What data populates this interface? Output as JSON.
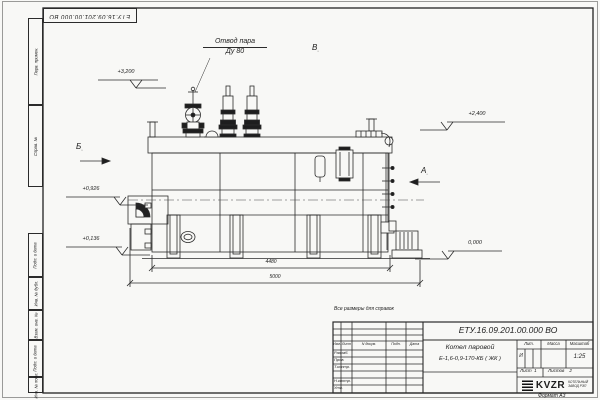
{
  "sheet": {
    "stamp_top": "ЕТУ.16.09.201.00.000  ВО",
    "format_note": "Формат  А3",
    "reference_note": "Все размеры для справок"
  },
  "margin": {
    "labels": [
      "Перв. примен.",
      "Справ. №",
      "Подп. и дата",
      "Инв. № дубл.",
      "Взам. инв. №",
      "Подп. и дата",
      "Инв. № подл."
    ]
  },
  "callouts": {
    "steam_outlet_line1": "Отвод пара",
    "steam_outlet_line2": "Ду 80",
    "view_a": "А",
    "view_b": "Б",
    "view_v": "В",
    "view_suffix": "◦",
    "elev_3200": "+3,200",
    "elev_2400": "+2,400",
    "elev_0926": "+0,926",
    "elev_0136": "+0,136",
    "elev_0000": "0,000",
    "dim_4480": "4480",
    "dim_5000": "5000"
  },
  "title_block": {
    "doc_number": "ЕТУ.16.09.201.00.000  ВО",
    "product_line1": "Котел паровой",
    "product_line2": "Е-1,6-0,9-170-КБ ( ЖК )",
    "rev_headers": {
      "izm": "Изм.",
      "list": "Лист",
      "doc": "N докум.",
      "sign": "Подп.",
      "date": "Дата"
    },
    "row_labels": {
      "developed": "Разраб.",
      "checked": "Пров.",
      "tcontrol": "Т.контр.",
      "ncontrol": "Н.контр.",
      "approved": "Утв."
    },
    "lit_header": "Лит.",
    "mass_header": "Масса",
    "scale_header": "Масштаб",
    "lit_value": "И",
    "scale_value": "1:25",
    "sheet_label": "Лист",
    "sheet_number": "1",
    "sheets_label": "Листов",
    "sheets_total": "2",
    "logo_text": "KVZR",
    "logo_sub1": "КОТЕЛЬНЫЙ",
    "logo_sub2": "ЗАВОД РЭП"
  }
}
